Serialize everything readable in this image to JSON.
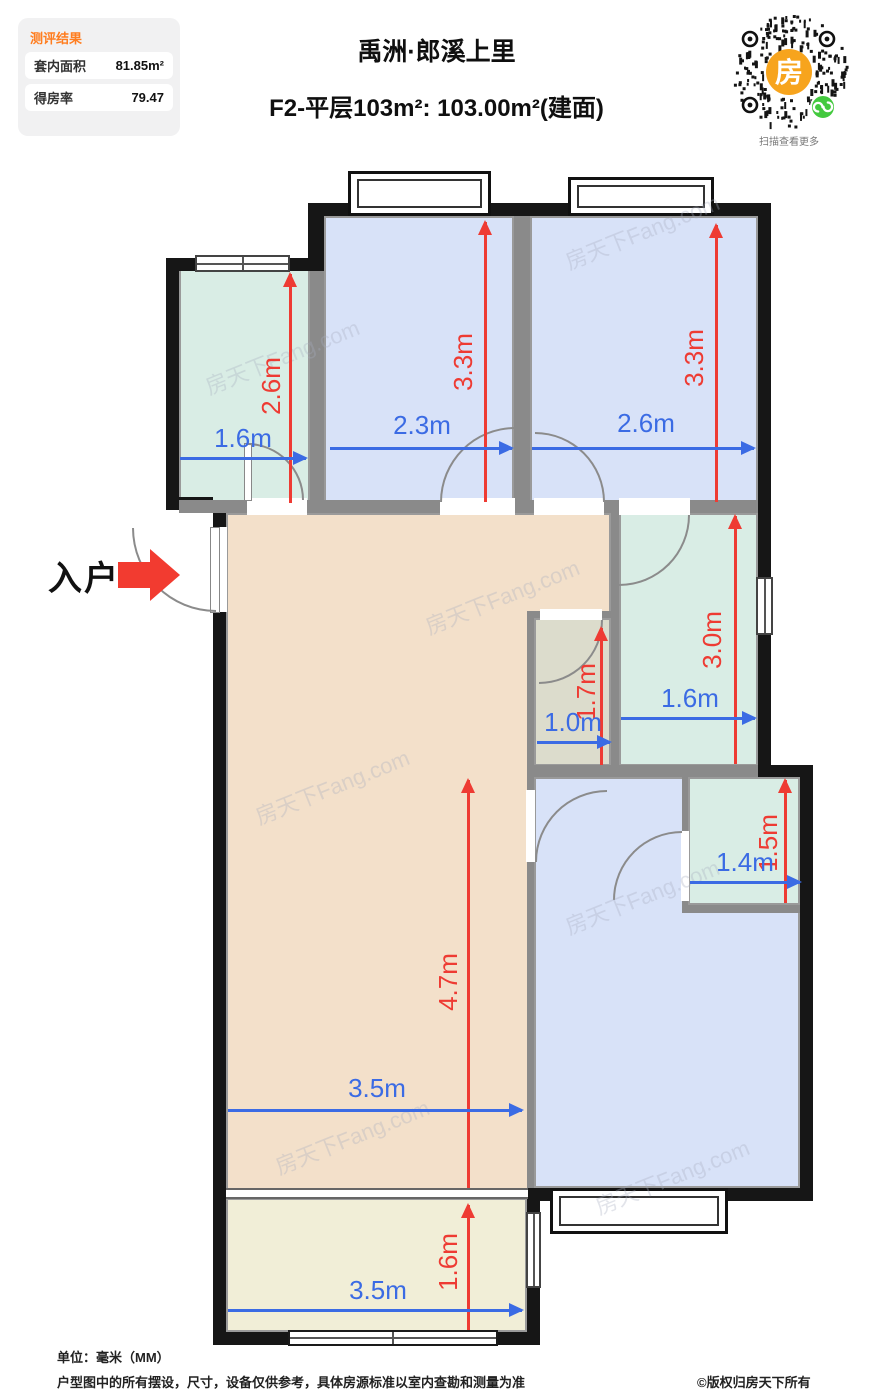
{
  "panel": {
    "title": "测评结果",
    "rows": [
      {
        "label": "套内面积",
        "value": "81.85m²"
      },
      {
        "label": "得房率",
        "value": "79.47"
      }
    ]
  },
  "header": {
    "title": "禹洲·郎溪上里",
    "subtitle": "F2-平层103m²: 103.00m²(建面)"
  },
  "qr": {
    "center_glyph": "房",
    "caption": "扫描查看更多",
    "brand_orange": "#f7a41d",
    "mini_program_green": "#43c93e"
  },
  "plan": {
    "entry_label": "入户",
    "watermark": "房天下Fang.com",
    "colors": {
      "wall": "#161616",
      "partition": "#8a8a8a",
      "bedroom_blue": "#d8e2f8",
      "teal_room": "#d9ede5",
      "living_tan": "#f3e0ca",
      "bath_gray": "#dcdccc",
      "balcony_cream": "#f1eed7",
      "dim_red": "#ee3b33",
      "dim_blue": "#3b6be4",
      "entry_red": "#f23b30"
    },
    "dims": {
      "storage_v": "2.6m",
      "storage_h": "1.6m",
      "bedroom1_v": "3.3m",
      "bedroom1_h": "2.3m",
      "bedroom2_v": "3.3m",
      "bedroom2_h": "2.6m",
      "kitchen_v": "3.0m",
      "kitchen_h": "1.6m",
      "bath_v": "1.7m",
      "bath_h": "1.0m",
      "living_v": "4.7m",
      "living_h": "3.5m",
      "toilet2_v": "1.5m",
      "toilet2_h": "1.4m",
      "balcony_v": "1.6m",
      "balcony_h": "3.5m"
    }
  },
  "footer": {
    "unit": "单位：毫米（MM）",
    "disclaimer": "户型图中的所有摆设，尺寸，设备仅供参考，具体房源标准以室内查勘和测量为准",
    "copyright": "©版权归房天下所有"
  }
}
